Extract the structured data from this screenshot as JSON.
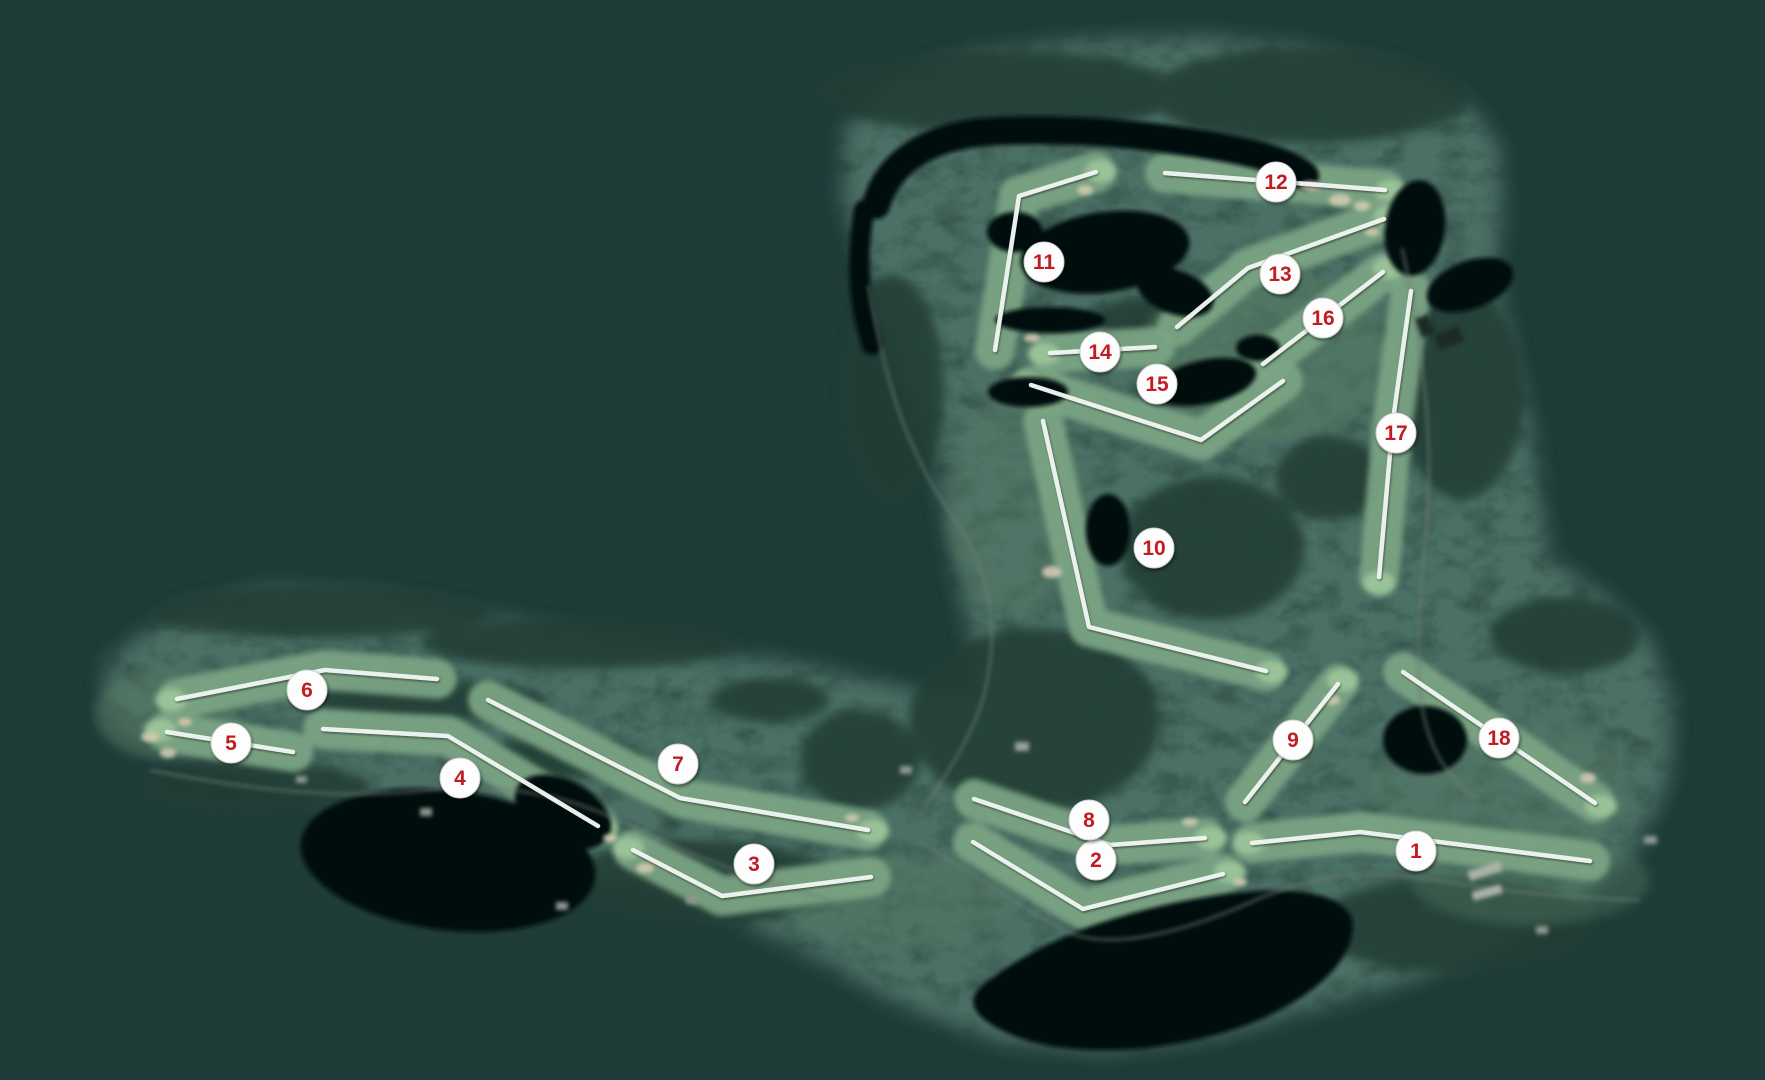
{
  "map": {
    "description": "golf-course-satellite-hole-map",
    "canvas": {
      "width": 1765,
      "height": 1080
    },
    "colors": {
      "background": "#1f3c39",
      "land": "#2d4b42",
      "forest": "#223d36",
      "grass_open": "#567a63",
      "fairway": "#7ca584",
      "green": "#9cc49a",
      "sand": "#d2cab0",
      "water": "#06100e",
      "road": "#6e7d74",
      "line": "#eff6f1",
      "marker_fill": "#fdfdfd",
      "marker_border": "#cfd4d0",
      "marker_text": "#c01f23"
    },
    "marker_radius": 20,
    "holes": [
      {
        "number": "1",
        "marker": {
          "x": 1416,
          "y": 851
        },
        "path": [
          [
            1252,
            843
          ],
          [
            1360,
            832
          ],
          [
            1590,
            861
          ]
        ],
        "green": [
          1249,
          843
        ]
      },
      {
        "number": "2",
        "marker": {
          "x": 1096,
          "y": 860
        },
        "path": [
          [
            973,
            842
          ],
          [
            1083,
            909
          ],
          [
            1223,
            874
          ]
        ],
        "green": [
          1230,
          872
        ]
      },
      {
        "number": "3",
        "marker": {
          "x": 754,
          "y": 864
        },
        "path": [
          [
            633,
            850
          ],
          [
            722,
            896
          ],
          [
            871,
            877
          ]
        ],
        "green": [
          628,
          848
        ]
      },
      {
        "number": "4",
        "marker": {
          "x": 460,
          "y": 778
        },
        "path": [
          [
            323,
            729
          ],
          [
            448,
            736
          ],
          [
            598,
            826
          ]
        ],
        "green": [
          602,
          829
        ]
      },
      {
        "number": "5",
        "marker": {
          "x": 231,
          "y": 743
        },
        "path": [
          [
            167,
            732
          ],
          [
            293,
            752
          ]
        ],
        "green": [
          160,
          730
        ]
      },
      {
        "number": "6",
        "marker": {
          "x": 307,
          "y": 690
        },
        "path": [
          [
            177,
            699
          ],
          [
            325,
            670
          ],
          [
            437,
            679
          ]
        ],
        "green": [
          171,
          700
        ]
      },
      {
        "number": "7",
        "marker": {
          "x": 678,
          "y": 764
        },
        "path": [
          [
            488,
            700
          ],
          [
            680,
            798
          ],
          [
            868,
            830
          ]
        ],
        "green": [
          873,
          831
        ]
      },
      {
        "number": "8",
        "marker": {
          "x": 1089,
          "y": 820
        },
        "path": [
          [
            974,
            799
          ],
          [
            1110,
            845
          ],
          [
            1205,
            838
          ]
        ],
        "green": [
          1211,
          838
        ]
      },
      {
        "number": "9",
        "marker": {
          "x": 1293,
          "y": 740
        },
        "path": [
          [
            1245,
            802
          ],
          [
            1338,
            684
          ]
        ],
        "green": [
          1343,
          680
        ]
      },
      {
        "number": "10",
        "marker": {
          "x": 1154,
          "y": 548
        },
        "path": [
          [
            1043,
            421
          ],
          [
            1089,
            627
          ],
          [
            1266,
            671
          ]
        ],
        "green": [
          1272,
          672
        ]
      },
      {
        "number": "11",
        "marker": {
          "x": 1044,
          "y": 262
        },
        "path": [
          [
            995,
            350
          ],
          [
            1019,
            196
          ],
          [
            1096,
            172
          ]
        ],
        "green": [
          1101,
          171
        ]
      },
      {
        "number": "12",
        "marker": {
          "x": 1276,
          "y": 182
        },
        "path": [
          [
            1165,
            173
          ],
          [
            1385,
            190
          ]
        ],
        "green": [
          1391,
          191
        ]
      },
      {
        "number": "13",
        "marker": {
          "x": 1280,
          "y": 274
        },
        "path": [
          [
            1177,
            327
          ],
          [
            1248,
            268
          ],
          [
            1384,
            219
          ]
        ],
        "green": [
          1390,
          217
        ]
      },
      {
        "number": "14",
        "marker": {
          "x": 1100,
          "y": 352
        },
        "path": [
          [
            1050,
            353
          ],
          [
            1155,
            347
          ]
        ],
        "green": [
          1044,
          354
        ]
      },
      {
        "number": "15",
        "marker": {
          "x": 1157,
          "y": 384
        },
        "path": [
          [
            1283,
            381
          ],
          [
            1201,
            440
          ],
          [
            1031,
            385
          ]
        ],
        "green": [
          1025,
          384
        ]
      },
      {
        "number": "16",
        "marker": {
          "x": 1323,
          "y": 318
        },
        "path": [
          [
            1263,
            364
          ],
          [
            1383,
            272
          ]
        ],
        "green": [
          1389,
          268
        ]
      },
      {
        "number": "17",
        "marker": {
          "x": 1396,
          "y": 433
        },
        "path": [
          [
            1411,
            291
          ],
          [
            1393,
            420
          ],
          [
            1379,
            577
          ]
        ],
        "green": [
          1379,
          583
        ]
      },
      {
        "number": "18",
        "marker": {
          "x": 1499,
          "y": 738
        },
        "path": [
          [
            1403,
            672
          ],
          [
            1595,
            803
          ]
        ],
        "green": [
          1601,
          806
        ]
      }
    ]
  }
}
